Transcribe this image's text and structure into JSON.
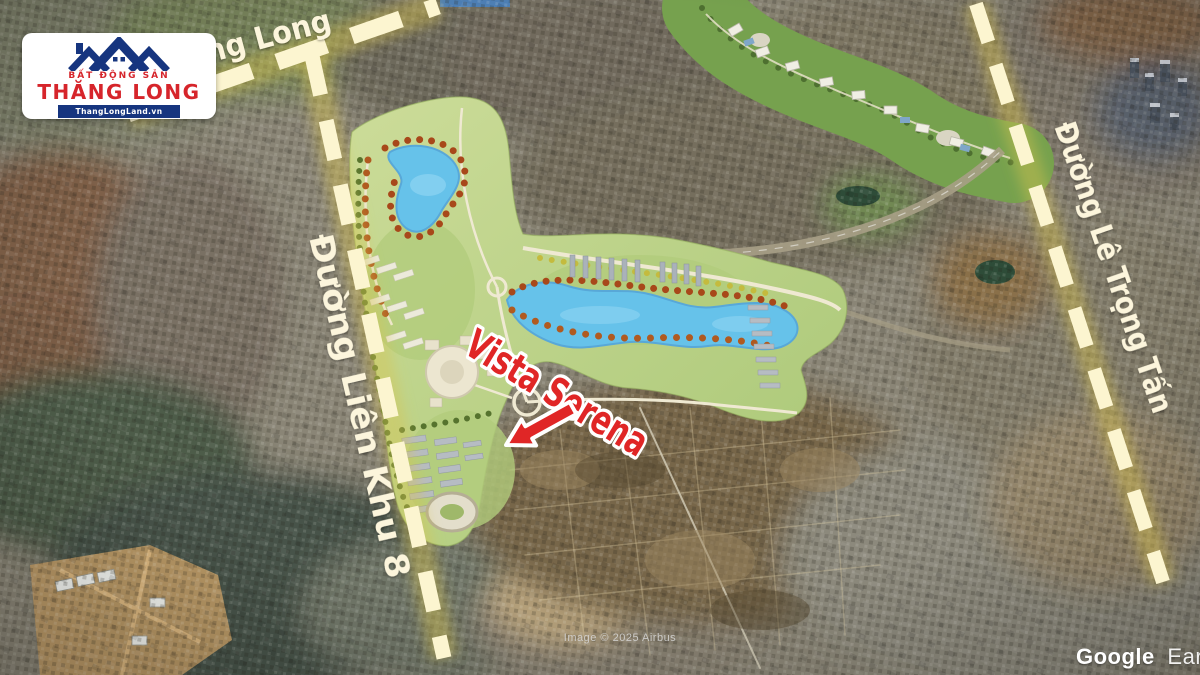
{
  "logo": {
    "tagline": "BẤT ĐỘNG SẢN",
    "brand": "THĂNG LONG",
    "website": "ThangLongLand.vn"
  },
  "map": {
    "road_labels": {
      "thang_long": "ăng Long",
      "lien_khu_8": "Đường Liên Khu 8",
      "le_trong_tan": "Đường Lê Trọng Tấn"
    },
    "project": {
      "label": "Vista Serena",
      "color": "#e02626"
    },
    "attribution": "Image © 2025 Airbus",
    "watermark": {
      "primary": "Google",
      "secondary": "Earth"
    },
    "colors": {
      "road_dash": "#fcf5d0",
      "road_glow": "#d9c44e",
      "label_text": "#fcf5dc",
      "plan_green": "#c3d68d",
      "lake_blue": "#66c2ea",
      "logo_navy": "#16357f",
      "logo_red": "#d6252b"
    }
  }
}
